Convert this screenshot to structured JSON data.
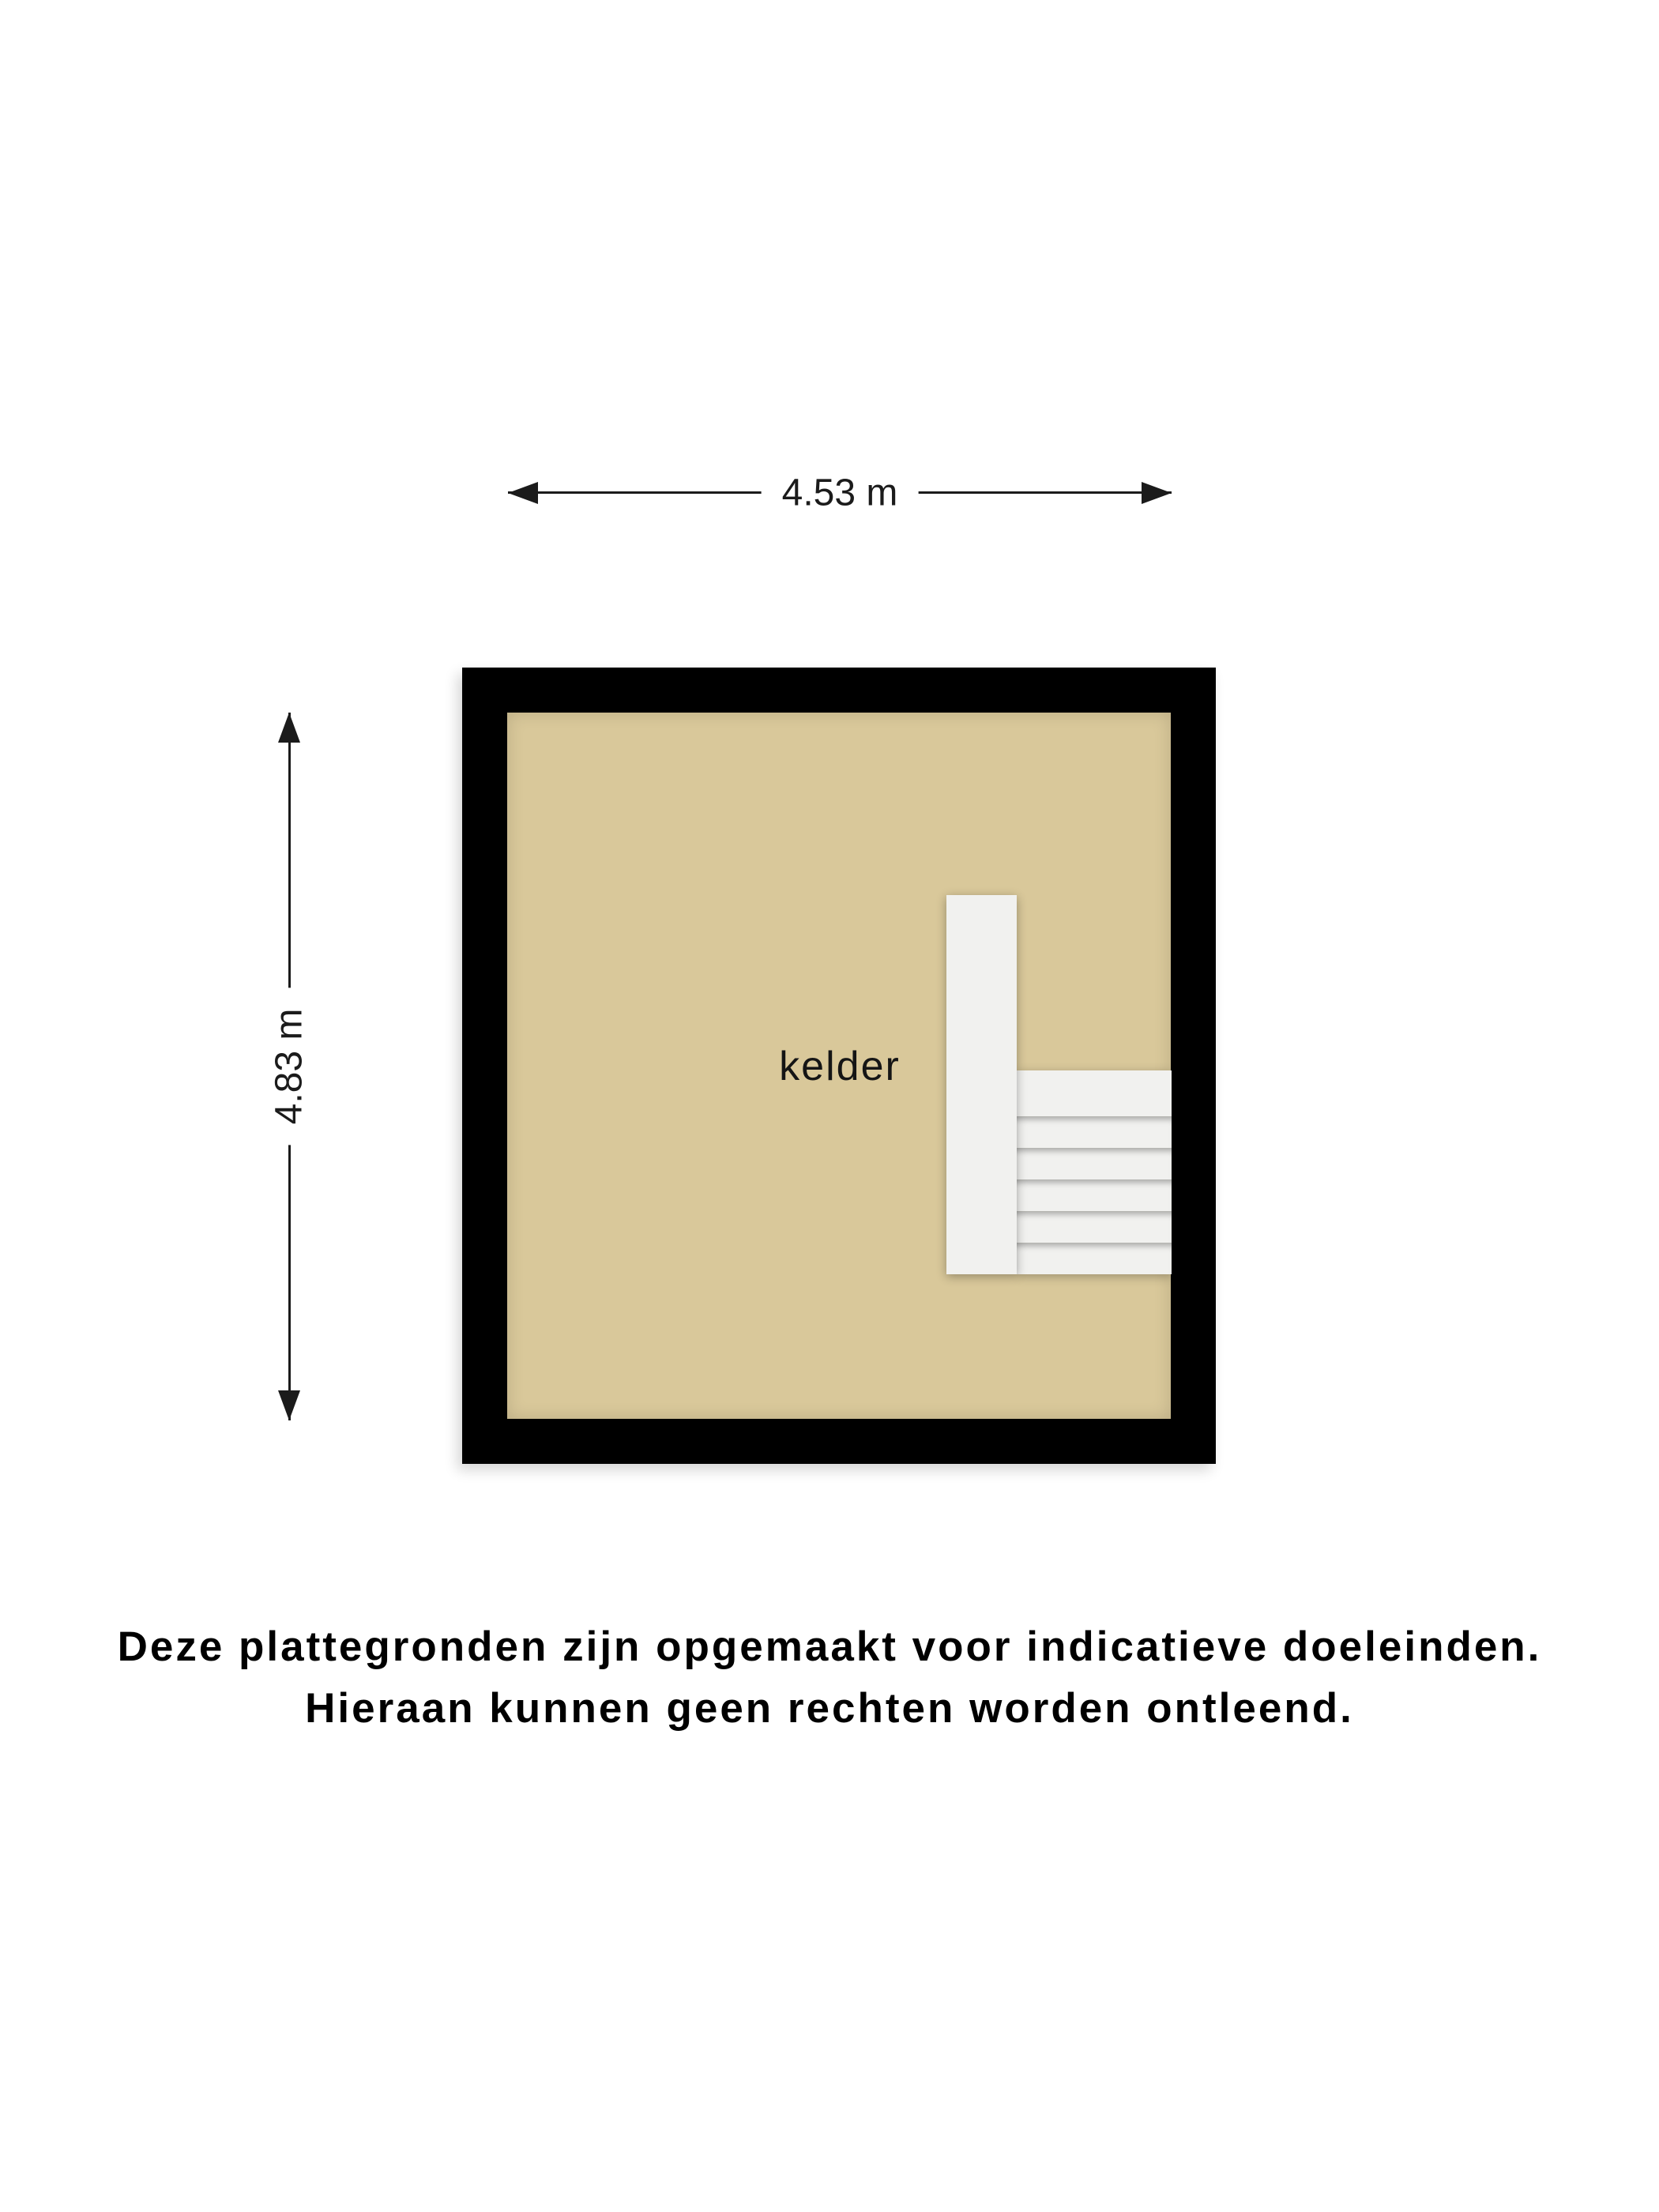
{
  "dimensions": {
    "width_label": "4.53 m",
    "height_label": "4.83 m"
  },
  "room": {
    "label": "kelder"
  },
  "stairs": {
    "tread_count": 6
  },
  "colors": {
    "wall": "#000000",
    "floor": "#d9c89a",
    "stair": "#f1f1ef",
    "dimension": "#1b1b1b",
    "page_background": "#ffffff"
  },
  "disclaimer": {
    "line1": "Deze plattegronden zijn opgemaakt voor indicatieve doeleinden.",
    "line2": "Hieraan kunnen geen rechten worden ontleend."
  }
}
